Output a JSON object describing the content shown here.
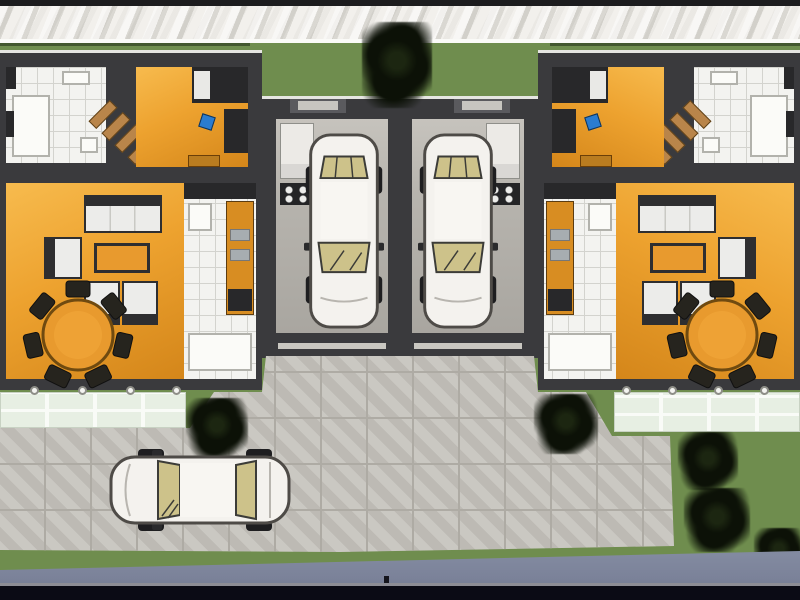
{
  "scene": {
    "kind": "3D architectural site plan, top-down render of two mirrored semi-detached houses",
    "site": {
      "back_strip": "light gravel band behind rear hedge",
      "rear_lawn": "green lawn strip across the top with central garden between the houses",
      "front_court": "large light-grey paved driveway court in front of the garages",
      "street": "blue-grey road along the bottom edge",
      "tree_count": 6
    },
    "houses": [
      {
        "side": "left",
        "rooms": [
          {
            "name": "bathroom",
            "floor": "white tile",
            "fixtures": [
              "bathtub",
              "sink",
              "toilet"
            ]
          },
          {
            "name": "staircase",
            "material": "wood steps"
          },
          {
            "name": "bedroom",
            "floor": "orange wood",
            "furniture": [
              "wardrobe-bed",
              "desk",
              "blue desk chair",
              "dresser"
            ]
          },
          {
            "name": "living-dining room",
            "floor": "orange wood",
            "furniture": [
              "three-seat sofa",
              "armchair",
              "two side chairs",
              "coffee table",
              "round dining table",
              "seven dining chairs"
            ]
          },
          {
            "name": "kitchen",
            "floor": "white tile",
            "fixtures": [
              "fridge",
              "orange counter",
              "double sink",
              "stove",
              "lower cabinets"
            ]
          }
        ],
        "terrace": {
          "tiles": "pale green glass tiles",
          "edge_lights": 4
        }
      },
      {
        "side": "right",
        "mirror_of": "left",
        "rooms": [
          {
            "name": "bedroom",
            "floor": "orange wood"
          },
          {
            "name": "bathroom",
            "floor": "white tile"
          },
          {
            "name": "living-dining room",
            "floor": "orange wood"
          },
          {
            "name": "kitchen",
            "floor": "white tile"
          }
        ],
        "terrace": {
          "tiles": "pale green glass tiles",
          "edge_lights": 4
        }
      }
    ],
    "garages": [
      {
        "side": "left",
        "contents": [
          "white car (top view)",
          "white cabinet",
          "dark shelf unit"
        ]
      },
      {
        "side": "right",
        "contents": [
          "white car (top view)",
          "white cabinet",
          "dark shelf unit"
        ]
      }
    ],
    "vehicles": [
      {
        "type": "sedan",
        "color": "white",
        "glass": "tan",
        "location": "left garage",
        "orientation": "vertical, nose toward court"
      },
      {
        "type": "sedan",
        "color": "white",
        "glass": "tan",
        "location": "right garage",
        "orientation": "vertical, nose toward court"
      },
      {
        "type": "sedan",
        "color": "white",
        "glass": "tan",
        "location": "front court",
        "orientation": "horizontal, nose toward left"
      }
    ]
  },
  "colors": {
    "frame": "#1c1c1e",
    "gravel": "#eae8e3",
    "white-line": "#fafaf7",
    "grass": "#6f8d4e",
    "grass-dark": "#42572e",
    "wall": "#3a3a3d",
    "wall-top": "#e6e6e2",
    "floor-orange": "#eda22f",
    "floor-white": "#f3f3f0",
    "tile-line": "#d3d3ce",
    "furn-white": "#ececea",
    "furn-dark": "#2e2e30",
    "table-orange": "#e89a2e",
    "wood-tan": "#b9854a",
    "chair-blue": "#2a7cd0",
    "concrete": "#b7b4ae",
    "paving": "#c3c0ba",
    "paving-joint": "#aeaba4",
    "terrace-tile": "#e7efe3",
    "terrace-grout": "#f9fbf7",
    "cabinet": "#eceae6",
    "car-body": "#f4f2ee",
    "car-glass": "#cdc28a",
    "car-outline": "#4e4b47",
    "tree-dark": "#0c1107",
    "tree-mid": "#1c2611",
    "road": "#7b8299",
    "bottom-bar": "#0b0b15",
    "bar-line": "#8d8d95"
  }
}
